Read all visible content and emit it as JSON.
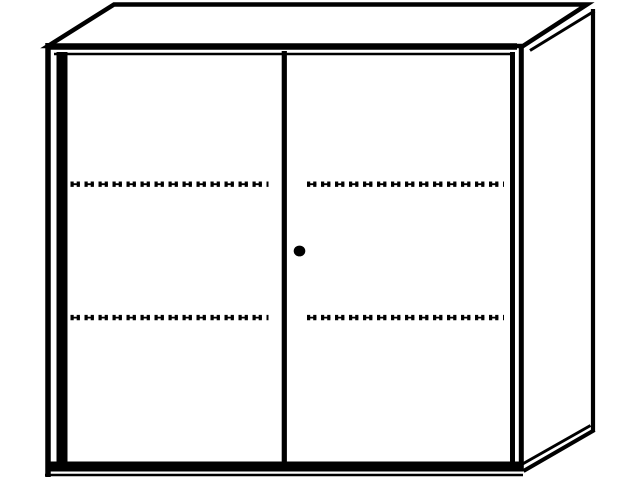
{
  "scene": {
    "subject": "two-door-cabinet-technical-line-drawing",
    "view": "front-oblique",
    "doors": "2",
    "dashed_shelf_lines_per_door": "2",
    "lock_indicator": "keyhole-dot",
    "shelf_line_style": "dashed-tick"
  },
  "colors": {
    "background": "#ffffff",
    "line": "#000000",
    "panel_fill": "#ffffff"
  }
}
